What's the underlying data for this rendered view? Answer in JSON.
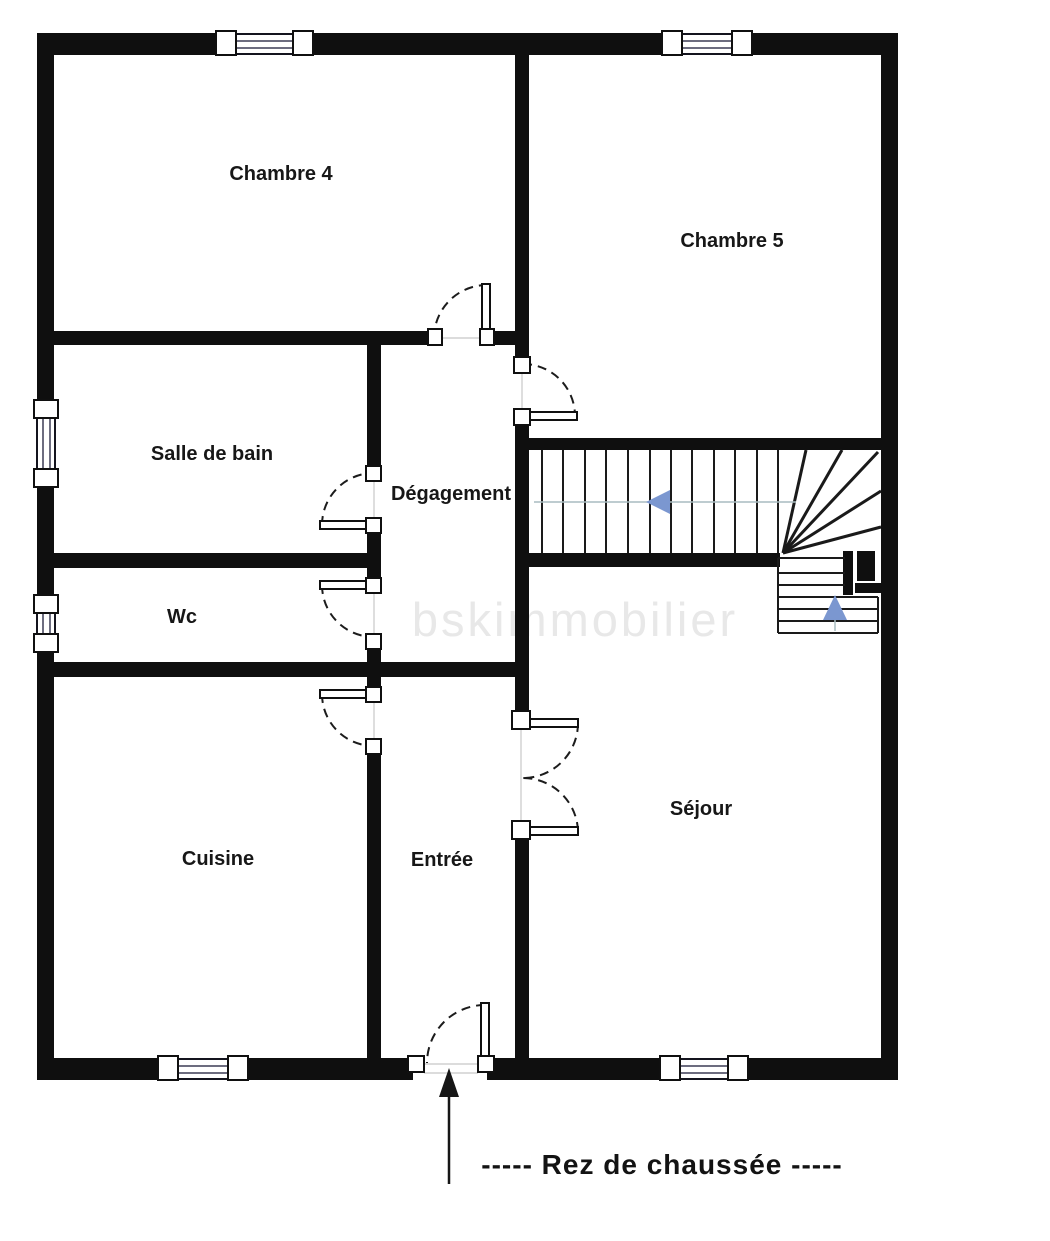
{
  "floor_plan": {
    "caption": "-----  Rez de chaussée  -----",
    "watermark": "bskimmobilier",
    "rooms": {
      "chambre4": "Chambre 4",
      "chambre5": "Chambre 5",
      "salle_de_bain": "Salle de bain",
      "degagement": "Dégagement",
      "wc": "Wc",
      "cuisine": "Cuisine",
      "entree": "Entrée",
      "sejour": "Séjour"
    },
    "stairs": {
      "main_run_direction": "left",
      "lower_run_direction": "up",
      "arrow_color": "#7b97d0"
    },
    "colors": {
      "wall": "#0f0f0f",
      "watermark": "#e8e8e8",
      "background": "#ffffff"
    }
  }
}
